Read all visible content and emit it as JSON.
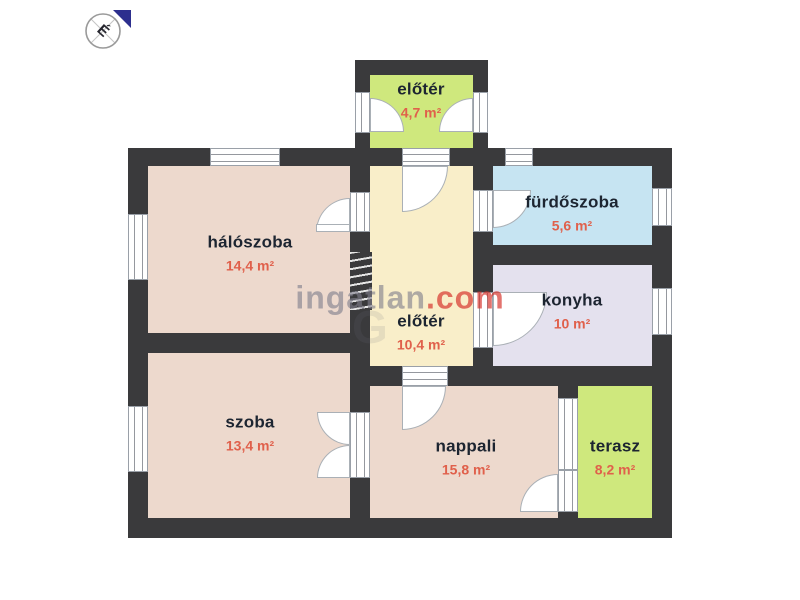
{
  "compass": {
    "north_label": "É"
  },
  "watermark": {
    "brand": "ingatlan",
    "tld": ".com",
    "echo": "G"
  },
  "rooms": [
    {
      "id": "entry-porch",
      "name": "előtér",
      "area": "4,7 m²",
      "color": "#cfe87d"
    },
    {
      "id": "bedroom",
      "name": "hálószoba",
      "area": "14,4 m²",
      "color": "#edd9cd"
    },
    {
      "id": "hall",
      "name": "előtér",
      "area": "10,4 m²",
      "color": "#f9eec9"
    },
    {
      "id": "bathroom",
      "name": "fürdőszoba",
      "area": "5,6 m²",
      "color": "#c6e4f2"
    },
    {
      "id": "kitchen",
      "name": "konyha",
      "area": "10 m²",
      "color": "#e4e1ee"
    },
    {
      "id": "room",
      "name": "szoba",
      "area": "13,4 m²",
      "color": "#edd9cd"
    },
    {
      "id": "living-room",
      "name": "nappali",
      "area": "15,8 m²",
      "color": "#edd9cd"
    },
    {
      "id": "terrace",
      "name": "terasz",
      "area": "8,2 m²",
      "color": "#cfe87d"
    }
  ],
  "colors": {
    "wall": "#3a3a3c",
    "room_name_text": "#1d2531",
    "area_text": "#e0604b",
    "compass_arrow": "#2d2f8e",
    "watermark_gray": "#807e8d",
    "watermark_red": "#d52a23"
  }
}
